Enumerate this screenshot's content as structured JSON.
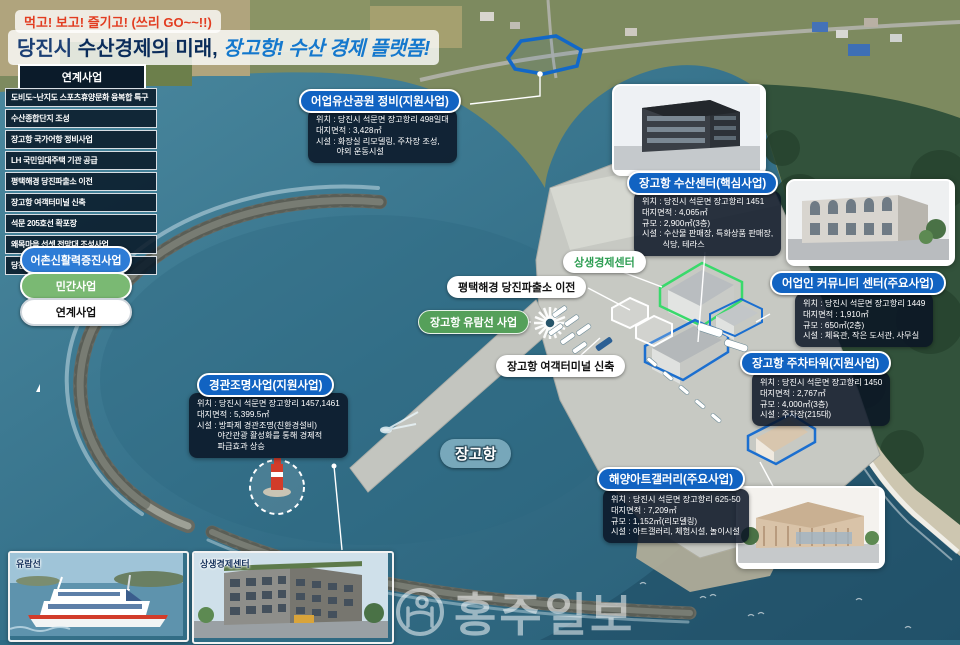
{
  "title": {
    "tagline": "먹고! 보고! 즐기고! (쓰리 GO~~!!)",
    "city": "당진시 ",
    "main": "수산경제의 미래, ",
    "highlight": "장고항! 수산 경제 플랫폼!"
  },
  "sidebar": {
    "header": "연계사업",
    "items": [
      "도비도~난지도 스포츠휴양문화 융복합 특구",
      "수산종합단지 조성",
      "장고항 국가어항 정비사업",
      "LH 국민임대주택 기관 공급",
      "평택해경 당진파출소 이전",
      "장고항 여객터미널 신축",
      "석문 205호선 확포장",
      "왜목마을 선셋 전망대 조성사업",
      "당진시립미술관 건립 지원"
    ]
  },
  "legend": {
    "items": [
      {
        "label": "어촌신활력증진사업",
        "color": "#2e7cd6"
      },
      {
        "label": "민간사업",
        "color": "#7ab973"
      },
      {
        "label": "연계사업",
        "color": "#ffffff"
      }
    ]
  },
  "callouts": [
    {
      "title": "어업유산공원 정비(지원사업)",
      "lines": [
        "위치 : 당진시 석문면 장고항리 498일대",
        "대지면적 : 3,428㎡",
        "시설 : 화장실 리모델링, 주차장 조성,",
        "         야외 운동시설"
      ]
    },
    {
      "title": "장고항 수산센터(핵심사업)",
      "lines": [
        "위치 : 당진시 석문면 장고항리 1451",
        "대지면적 : 4,065㎡",
        "규모 : 2,900㎡(3층)",
        "시설 : 수산물 판매장, 특화상품 판매장,",
        "         식당, 테라스"
      ]
    },
    {
      "title": "어업인 커뮤니티 센터(주요사업)",
      "lines": [
        "위치 : 당진시 석문면 장고항리 1449",
        "대지면적 : 1,910㎡",
        "규모 : 650㎡(2층)",
        "시설 : 체육관, 작은 도서관, 사무실"
      ]
    },
    {
      "title": "장고항 주차타워(지원사업)",
      "lines": [
        "위치 : 당진시 석문면 장고항리 1450",
        "대지면적 : 2,767㎡",
        "규모 : 4,000㎡(3층)",
        "시설 : 주차장(215대)"
      ]
    },
    {
      "title": "경관조명사업(지원사업)",
      "lines": [
        "위치 : 당진시 석문면 장고항리 1457,1461",
        "대지면적 : 5,399.5㎡",
        "시설 : 방파제 경관조명(친환경설비)",
        "         야간관광 활성화를 통해 경제적",
        "         파급효과 상승"
      ]
    },
    {
      "title": "해양아트갤러리(주요사업)",
      "lines": [
        "위치 : 당진시 석문면 장고항리 625-50",
        "대지면적 : 7,209㎡",
        "규모 : 1,152㎡(리모델링)",
        "시설 : 아트갤러리, 체험시설, 놀이시설"
      ]
    }
  ],
  "map_labels": {
    "sangsaeng": "상생경제센터",
    "coastguard": "평택해경 당진파출소 이전",
    "cruise": "장고항 유람선 사업",
    "terminal": "장고항 여객터미널 신축",
    "port": "장고항"
  },
  "thumbnails": [
    {
      "caption": "유람선"
    },
    {
      "caption": "상생경제센터"
    }
  ],
  "watermark": "홍주일보"
}
